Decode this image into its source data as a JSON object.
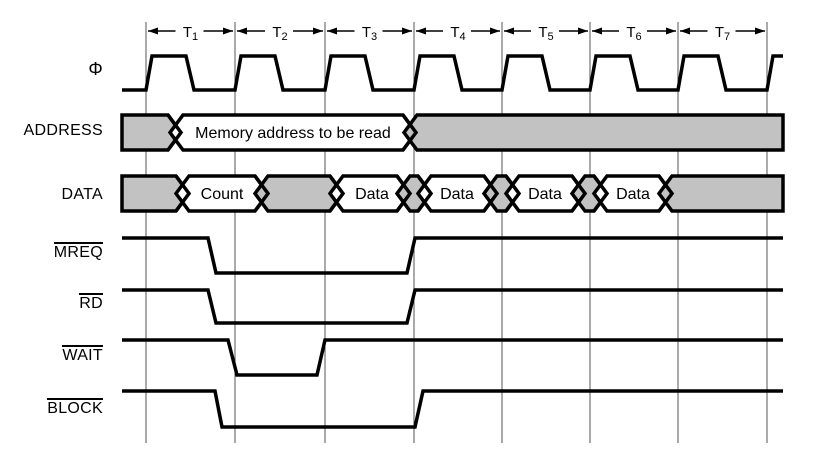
{
  "diagram": {
    "cycle_labels": [
      {
        "base": "T",
        "sub": "1"
      },
      {
        "base": "T",
        "sub": "2"
      },
      {
        "base": "T",
        "sub": "3"
      },
      {
        "base": "T",
        "sub": "4"
      },
      {
        "base": "T",
        "sub": "5"
      },
      {
        "base": "T",
        "sub": "6"
      },
      {
        "base": "T",
        "sub": "7"
      }
    ],
    "row_labels": {
      "phi": "Φ",
      "address": "ADDRESS",
      "data": "DATA",
      "mreq": "MREQ",
      "rd": "RD",
      "wait": "WAIT",
      "block": "BLOCK"
    },
    "overlined_rows": [
      "MREQ",
      "RD",
      "WAIT",
      "BLOCK"
    ],
    "bus_values": {
      "address_valid": "Memory address to be read",
      "data_segments": [
        "Count",
        "Data",
        "Data",
        "Data",
        "Data"
      ]
    },
    "colors": {
      "background": "#ffffff",
      "line": "#000000",
      "bus_fill": "#c2c2c2",
      "bus_valid_fill": "#ffffff",
      "gridline": "#555555"
    }
  }
}
